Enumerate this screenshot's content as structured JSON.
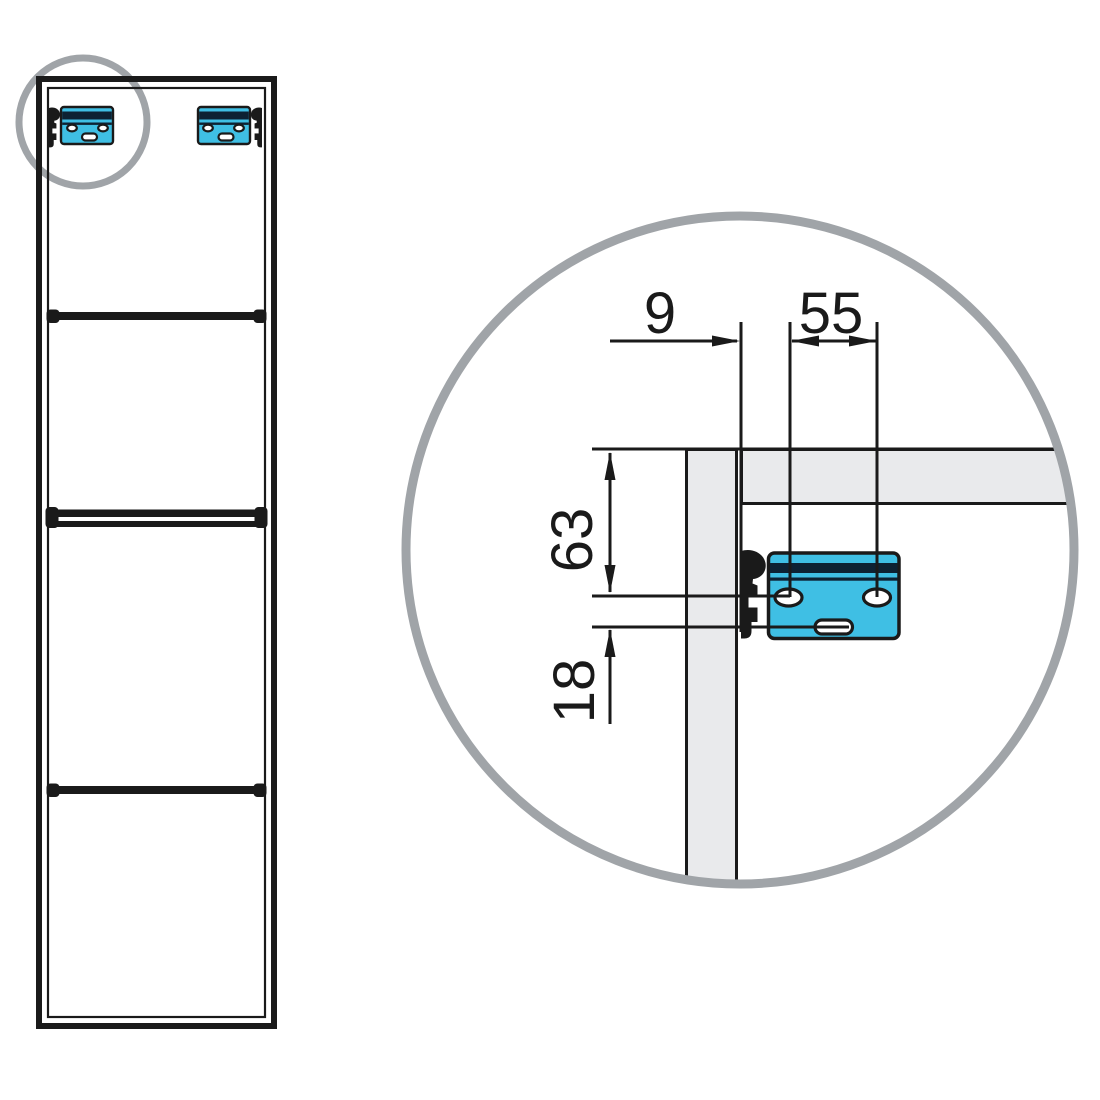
{
  "drawing": {
    "dimension_labels": {
      "side_offset": "9",
      "hole_spacing": "55",
      "top_to_holes": "63",
      "holes_to_slot": "18"
    },
    "colors": {
      "line": "#1A1A1A",
      "bracket_fill": "#3FBFE4",
      "bracket_stripe": "#0D2233",
      "panel_fill": "#E9EAEC",
      "highlight_gray": "#A0A4A8",
      "background": "#FFFFFF"
    }
  }
}
